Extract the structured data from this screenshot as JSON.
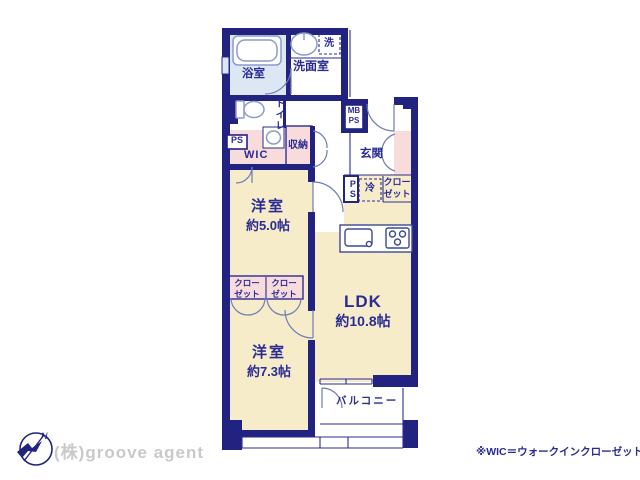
{
  "rooms": {
    "bathroom": {
      "label": "浴室"
    },
    "washroom": {
      "label": "洗面室"
    },
    "laundry": {
      "label": "洗"
    },
    "toilet": {
      "label": "トイレ"
    },
    "wic": {
      "label": "WIC"
    },
    "storage": {
      "label": "収納"
    },
    "entrance": {
      "label": "玄関"
    },
    "bedroom1": {
      "label": "洋室",
      "size": "約5.0帖"
    },
    "ldk": {
      "label": "LDK",
      "size": "約10.8帖"
    },
    "bedroom2": {
      "label": "洋室",
      "size": "約7.3帖"
    },
    "balcony": {
      "label": "バルコニー"
    }
  },
  "utility": {
    "ps": "PS",
    "mb": "MB",
    "fridge": "冷",
    "closet_line1": "クロー",
    "closet_line2": "ゼット"
  },
  "compass": {
    "north": "N"
  },
  "footer": {
    "company": "(株)groove agent",
    "note": "※WIC＝ウォークインクローゼット"
  },
  "colors": {
    "wall_navy": "#222280",
    "label_navy": "#2b2b94",
    "room_cream": "#f6ecca",
    "closet_pink": "#f8dbdb",
    "bath_blue": "#dde7f4",
    "fixture_stroke": "#8b9cc8",
    "company_gray": "#c9c9c9"
  }
}
